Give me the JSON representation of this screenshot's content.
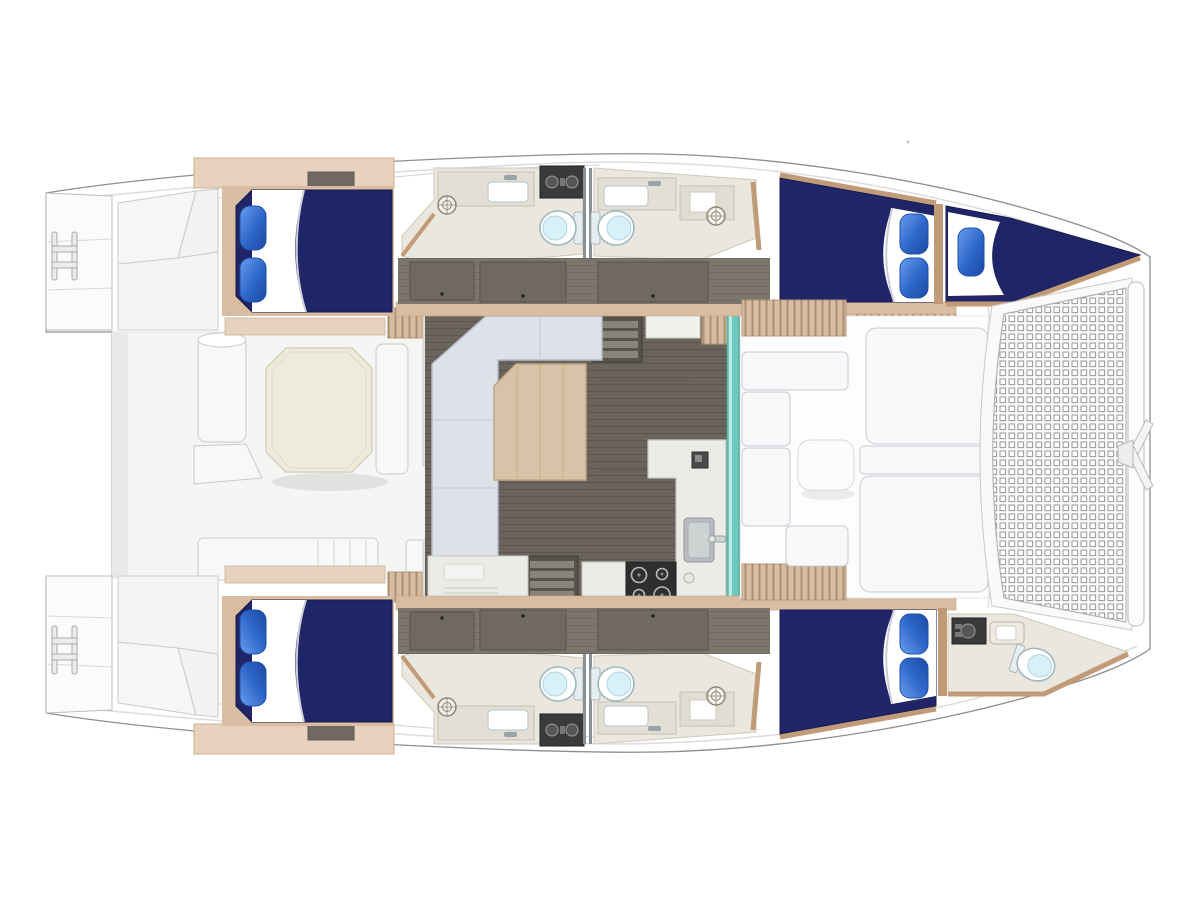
{
  "meta": {
    "canvas_width": 1200,
    "canvas_height": 900,
    "description_kind": "catamaran-floorplan"
  },
  "palette": {
    "bg": "#ffffff",
    "outline": "#8f8f8f",
    "deck": "#ffffff",
    "deck_line": "#dcdcdc",
    "cockpit_floor": "#f5f5f3",
    "cockpit_shadow": "#e9e9e8",
    "cushion": "#f7f8f9",
    "cushion_line": "#c6cbd1",
    "octagon": "#edebdd",
    "octagon_line": "#d5d2bf",
    "wood": "#d8bda2",
    "wood_dark": "#c19a77",
    "shelf": "#e6d2bd",
    "floor_taupe": "#7c756c",
    "salon_floor": "#6b645c",
    "wardrobe": "#6f6961",
    "wardrobe_line": "#59534c",
    "bath_floor": "#eae7de",
    "bath_trim": "#cfc9ba",
    "counter": "#ebebe7",
    "counter_line": "#c6c6c0",
    "bed_navy": "#1f2566",
    "bed_navy_dark": "#161b4d",
    "pillow_edge": "#1d4fa8",
    "sheet": "#ffffff",
    "sheet_shadow": "#c9cdd8",
    "teal": "#6cc9bd",
    "teal_light": "#bfeae3",
    "teal_dark": "#3fa396",
    "stove": "#2e2e2e",
    "steel": "#b9b9b9",
    "sink_gray": "#b9bdbf",
    "toilet_line": "#9fb6bd",
    "toilet_lid": "#d8f0fa",
    "panel_dark": "#3a3a3a",
    "dial": "#9aa0a3",
    "mesh_line": "#9e9e9e",
    "mesh_bg": "#fdfdfd",
    "sofa": "#dde1e8",
    "sofa_line": "#b3bac6",
    "table_wood": "#d9c3a8",
    "table_line": "#c0a685",
    "steps": "#57524b",
    "tread": "#8a837a",
    "white_panel": "#fbfbfb",
    "panel_stroke": "#bdbdbd"
  },
  "icons": {
    "toilet": "oval-bowl-with-tank",
    "shower_drain": "circle-with-cross",
    "stove": "four-burner-cooktop",
    "sink": "rounded-basin",
    "swim_ladder": "double-rail-ladder",
    "anchor_bridle": "v-bridle",
    "trampoline": "square-mesh-net",
    "systems_panel": "dark-panel-with-dials"
  },
  "features": {
    "hulls": 2,
    "double_berths": 4,
    "v_berths": 1,
    "pillows": 9,
    "toilets": 5,
    "shower_drains": 4,
    "stove_burners": 4,
    "salon_tables": 1,
    "cockpit_tables": 1,
    "foredeck_tables": 1,
    "trampoline": true,
    "companionway_steps": 2
  }
}
